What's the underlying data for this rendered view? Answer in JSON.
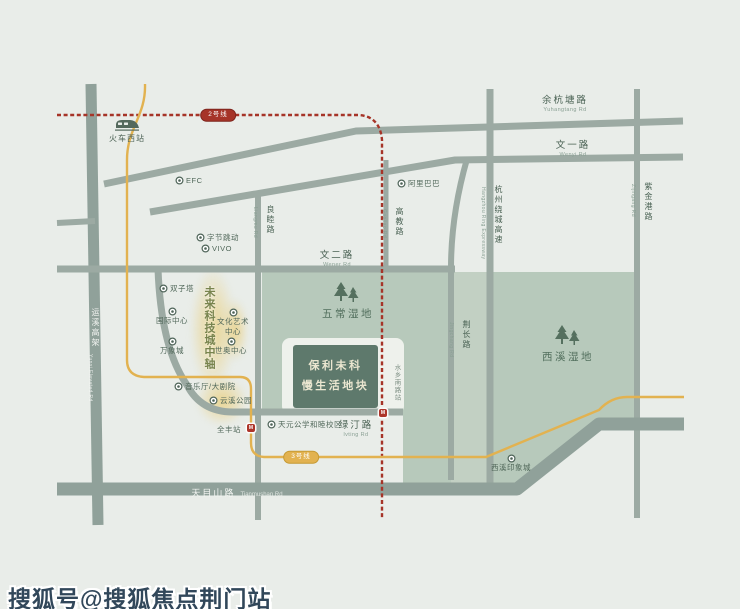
{
  "watermark": {
    "text": "搜狐号@搜狐焦点荆门站"
  },
  "map": {
    "colors": {
      "background": "#e9ede9",
      "road": "#9caaa3",
      "road_dark": "#90a19a",
      "wetland": "#b7c9bb",
      "wetland_light": "#c2d0c3",
      "plot_halo": "#eef1ec",
      "label": "#4a6254",
      "label_en": "#8aa094",
      "poi_text": "#51685a",
      "metro_red": "#a63428",
      "metro_yellow": "#e2b250",
      "site_fill": "#5e796c",
      "site_text": "#eae6d0",
      "axis_text": "#78844e",
      "watermark": "#31475a"
    },
    "areas": [
      {
        "name": "wuchang-xixi-wetland-area",
        "d": "M262,272 L637,272 L637,421 L598,421 L513,486 L403,486 L403,412 L262,412 Z",
        "fill": "#b7c9bb"
      },
      {
        "name": "wetland-east-strip-area",
        "d": "M451,272 L487,272 L487,486 L451,486 Z",
        "fill": "#c2d0c3"
      }
    ],
    "plot_halo": {
      "x": 282,
      "y": 338,
      "w": 122,
      "h": 76,
      "fill": "#eef1ec"
    },
    "axis_glow": [
      {
        "x": 190,
        "y": 266,
        "w": 46,
        "h": 126
      },
      {
        "x": 196,
        "y": 376,
        "w": 52,
        "h": 50
      },
      {
        "x": 222,
        "y": 298,
        "w": 26,
        "h": 64
      }
    ],
    "roads": [
      {
        "name": "yunxi-elevated",
        "d": "M91,84 L98,525",
        "w": 11,
        "c": "#90a19a"
      },
      {
        "name": "yuhangtang",
        "d": "M104,184 L356,131 L683,121",
        "w": 7
      },
      {
        "name": "wenyi",
        "d": "M150,212 L455,160 L683,157",
        "w": 7
      },
      {
        "name": "wener",
        "d": "M57,269 L455,269",
        "w": 7
      },
      {
        "name": "west-stub",
        "d": "M57,223 L95,221",
        "w": 6
      },
      {
        "name": "liangmu",
        "d": "M258,191 L258,520",
        "w": 6
      },
      {
        "name": "gaojiao",
        "d": "M386,160 L386,270",
        "w": 5
      },
      {
        "name": "jingchang",
        "d": "M467,159 Q451,215 451,268 L451,480",
        "w": 6
      },
      {
        "name": "ring-expressway",
        "d": "M490,89 L490,489",
        "w": 7
      },
      {
        "name": "zijingang",
        "d": "M637,89 L637,518",
        "w": 6
      },
      {
        "name": "lvting",
        "d": "M158,269 Q161,348 187,385 Q201,412 233,412 L403,412",
        "w": 7
      },
      {
        "name": "tianmushan",
        "d": "M57,489 L517,489 L599,424 L684,424",
        "w": 13,
        "c": "#90a19a"
      }
    ],
    "metro_lines": [
      {
        "name": "metro-line-2",
        "label": "2号线",
        "color": "#a63428",
        "border": "#7e241c",
        "dashed": true,
        "path": "M57,115 L358,115 Q380,116 382,140 L382,518",
        "capsule": {
          "x": 218,
          "y": 115
        }
      },
      {
        "name": "metro-line-3",
        "label": "3号线",
        "color": "#e2b250",
        "border": "#c69a33",
        "dashed": false,
        "path": "M145,84 C146,116 127,128 127,160 L127,360 Q127,376 144,377 L240,377 Q251,377 251,389 L251,443 Q251,456 264,457 L486,457 L599,410 Q611,397 627,397 L684,397",
        "capsule": {
          "x": 301,
          "y": 457
        }
      }
    ],
    "stations": [
      {
        "name": "shuixiang-south-rd-station-marker",
        "x": 383,
        "y": 413
      },
      {
        "name": "quanfeng-station-marker",
        "x": 251,
        "y": 428
      }
    ],
    "site_block": {
      "x": 293,
      "y": 345,
      "w": 85,
      "h": 63,
      "lines": [
        "保利未科",
        "慢生活地块"
      ]
    },
    "axis_label": {
      "text": "未来科技城中轴",
      "x": 201,
      "y": 286
    },
    "train_station": {
      "label": "火车西站",
      "x": 127,
      "y": 116
    },
    "wetland_labels": [
      {
        "name": "wuchang-wetland",
        "label": "五常湿地",
        "x": 348,
        "y": 306,
        "tree_x": 347,
        "tree_y": 281
      },
      {
        "name": "xixi-wetland",
        "label": "西溪湿地",
        "x": 568,
        "y": 349,
        "tree_x": 568,
        "tree_y": 324
      }
    ],
    "road_labels_h": [
      {
        "name": "yuhangtang-rd-label",
        "zh": "余杭塘路",
        "en": "Yuhangtang Rd",
        "x": 565,
        "y": 92
      },
      {
        "name": "wenyi-rd-label",
        "zh": "文一路",
        "en": "Wenyi Rd",
        "x": 573,
        "y": 137
      },
      {
        "name": "wener-rd-label",
        "zh": "文二路",
        "en": "Wener Rd",
        "x": 337,
        "y": 247
      },
      {
        "name": "lvting-rd-label",
        "zh": "绿汀路",
        "en": "lvting Rd",
        "x": 356,
        "y": 417
      }
    ],
    "road_label_on_road": {
      "name": "tianmushan-rd-label",
      "zh": "天目山路",
      "en": "Tianmushan Rd",
      "x": 237,
      "y": 483
    },
    "road_labels_v": [
      {
        "name": "liangmu-rd-label",
        "zh": "良睦路",
        "en": "Liangmu Rd",
        "x": 270,
        "y": 205
      },
      {
        "name": "gaojiao-rd-label",
        "zh": "高教路",
        "en": "Gaojiao Rd",
        "x": 399,
        "y": 207
      },
      {
        "name": "jingchang-rd-label",
        "zh": "荆长路",
        "en": "Jingchang Rd",
        "x": 466,
        "y": 320
      },
      {
        "name": "ring-expressway-label",
        "zh": "杭州绕城高速",
        "en": "Hangzhou Ring Expressway",
        "x": 498,
        "y": 185
      },
      {
        "name": "zijingang-rd-label",
        "zh": "紫金港路",
        "en": "Zijingang Rd",
        "x": 648,
        "y": 182
      },
      {
        "name": "yunxi-elevated-label",
        "zh": "运溪高架",
        "en": "Yunxi Elevated Rd",
        "x": 95,
        "y": 308,
        "white": true
      },
      {
        "name": "shuixiang-south-rd-station-label",
        "zh": "水乡南路站",
        "en": "",
        "x": 396,
        "y": 364,
        "small": true
      }
    ],
    "pois": [
      {
        "name": "poi-efc",
        "label": "EFC",
        "x": 177,
        "y": 181,
        "layout": "right"
      },
      {
        "name": "poi-bytedance",
        "label": "字节跳动",
        "x": 198,
        "y": 237,
        "layout": "right"
      },
      {
        "name": "poi-vivo",
        "label": "VIVO",
        "x": 203,
        "y": 249,
        "layout": "right"
      },
      {
        "name": "poi-alibaba",
        "label": "阿里巴巴",
        "x": 399,
        "y": 183,
        "layout": "right"
      },
      {
        "name": "poi-twin-towers",
        "label": "双子塔",
        "x": 161,
        "y": 288,
        "layout": "right"
      },
      {
        "name": "poi-concert-hall",
        "label": "音乐厅/大剧院",
        "x": 176,
        "y": 386,
        "layout": "right"
      },
      {
        "name": "poi-yunxi-park",
        "label": "云溪公园",
        "x": 211,
        "y": 400,
        "layout": "right"
      },
      {
        "name": "poi-tianyuan-school",
        "label": "天元公学和睦校区",
        "x": 269,
        "y": 424,
        "layout": "right"
      },
      {
        "name": "poi-quanfeng-station",
        "label": "全丰站",
        "x": 245,
        "y": 424,
        "layout": "left"
      },
      {
        "name": "poi-international-center",
        "lines": [
          "国际中心"
        ],
        "x": 172,
        "y": 306,
        "layout": "below"
      },
      {
        "name": "poi-culture-art-center",
        "lines": [
          "文化艺术",
          "中心"
        ],
        "x": 233,
        "y": 307,
        "layout": "below"
      },
      {
        "name": "poi-mixc",
        "lines": [
          "万象城"
        ],
        "x": 172,
        "y": 336,
        "layout": "below"
      },
      {
        "name": "poi-shiao-center",
        "lines": [
          "世奥中心"
        ],
        "x": 231,
        "y": 336,
        "layout": "below"
      },
      {
        "name": "poi-xixi-impression-city",
        "lines": [
          "西溪印象城"
        ],
        "x": 511,
        "y": 453,
        "layout": "below"
      }
    ]
  }
}
